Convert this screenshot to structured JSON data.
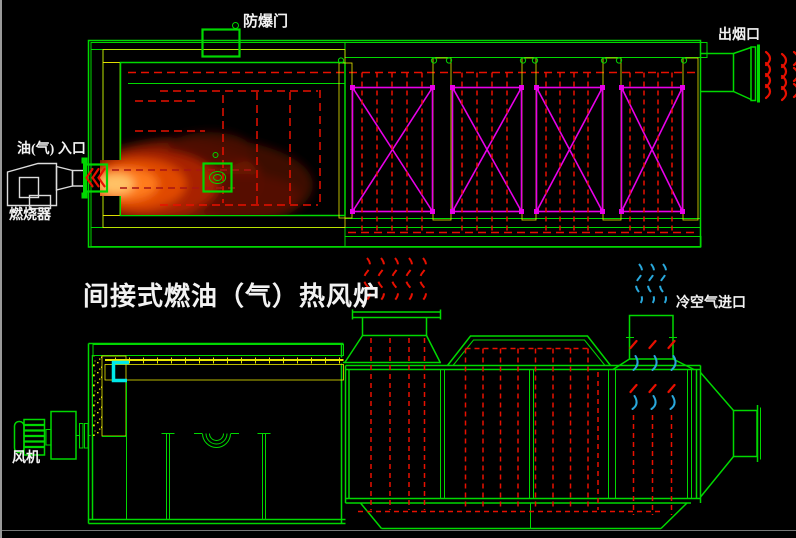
{
  "title": {
    "text": "间接式燃油（气）热风炉"
  },
  "labels": {
    "explosion_door": "防爆门",
    "smoke_outlet": "出烟口",
    "oil_gas_inlet": "油(气) 入口",
    "burner": "燃烧器",
    "cold_air_inlet": "冷空气进口",
    "fan": "风机"
  },
  "colors": {
    "green": "#00d800",
    "yellow": "#e8e800",
    "red": "#e81000",
    "darkred": "#a81414",
    "magenta": "#e800e8",
    "cyan": "#00e8e8",
    "coldblue": "#29a8dc",
    "whiteline": "#dcdcdc",
    "text": "#f2f2f2"
  }
}
